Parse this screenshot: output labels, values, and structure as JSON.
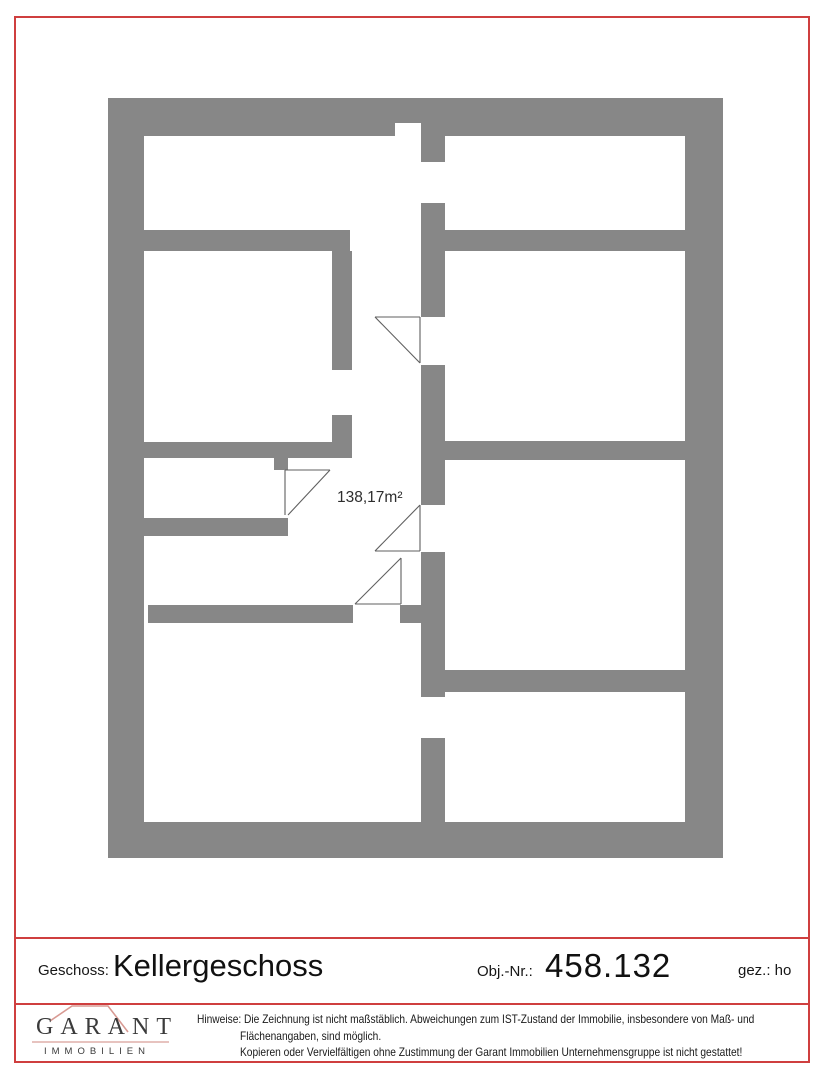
{
  "page": {
    "background": "#ffffff",
    "border_color": "#cf3f3f"
  },
  "floorplan": {
    "wall_color": "#878787",
    "area_label": "138,17m²"
  },
  "title_block": {
    "geschoss_label": "Geschoss:",
    "geschoss_value": "Kellergeschoss",
    "obj_nr_label": "Obj.-Nr.:",
    "obj_nr_value": "458.132",
    "gez_value": "gez.: ho"
  },
  "footer": {
    "logo": {
      "name": "GARANT",
      "subtitle": "IMMOBILIEN",
      "roof_color": "#d89a93",
      "underline_color": "#e7c3bf"
    },
    "disclaimer": {
      "line1": "Hinweise: Die Zeichnung ist nicht maßstäblich. Abweichungen zum IST-Zustand der Immobilie, insbesondere von Maß- und",
      "line2": "Flächenangaben, sind möglich.",
      "line3": "Kopieren oder Vervielfältigen ohne Zustimmung der Garant Immobilien Unternehmensgruppe ist nicht gestattet!"
    }
  }
}
